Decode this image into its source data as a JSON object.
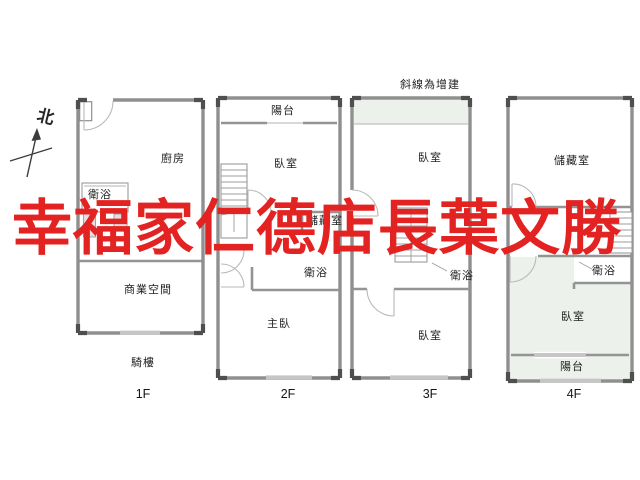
{
  "compass": {
    "label": "北"
  },
  "annotation": {
    "extension_note": "斜線為增建"
  },
  "watermark": {
    "text": "幸福家仁德店長葉文勝",
    "color": "#e32222"
  },
  "floors": [
    {
      "label": "1F",
      "rooms": {
        "kitchen": "廚房",
        "bathroom": "衛浴",
        "commercial_space": "商業空間"
      },
      "outdoor": {
        "arcade": "騎樓"
      }
    },
    {
      "label": "2F",
      "rooms": {
        "balcony": "陽台",
        "bedroom": "臥室",
        "storage": "儲藏室",
        "bathroom": "衛浴",
        "master_bedroom": "主臥"
      }
    },
    {
      "label": "3F",
      "rooms": {
        "bedroom_upper": "臥室",
        "bathroom": "衛浴",
        "bedroom_lower": "臥室"
      }
    },
    {
      "label": "4F",
      "rooms": {
        "storage": "儲藏室",
        "bathroom": "衛浴",
        "bedroom": "臥室",
        "balcony": "陽台"
      }
    }
  ],
  "colors": {
    "watermark_red": "#e32222",
    "wall_gray": "#8f8f8f",
    "extension_fill": "#edf1ec"
  }
}
